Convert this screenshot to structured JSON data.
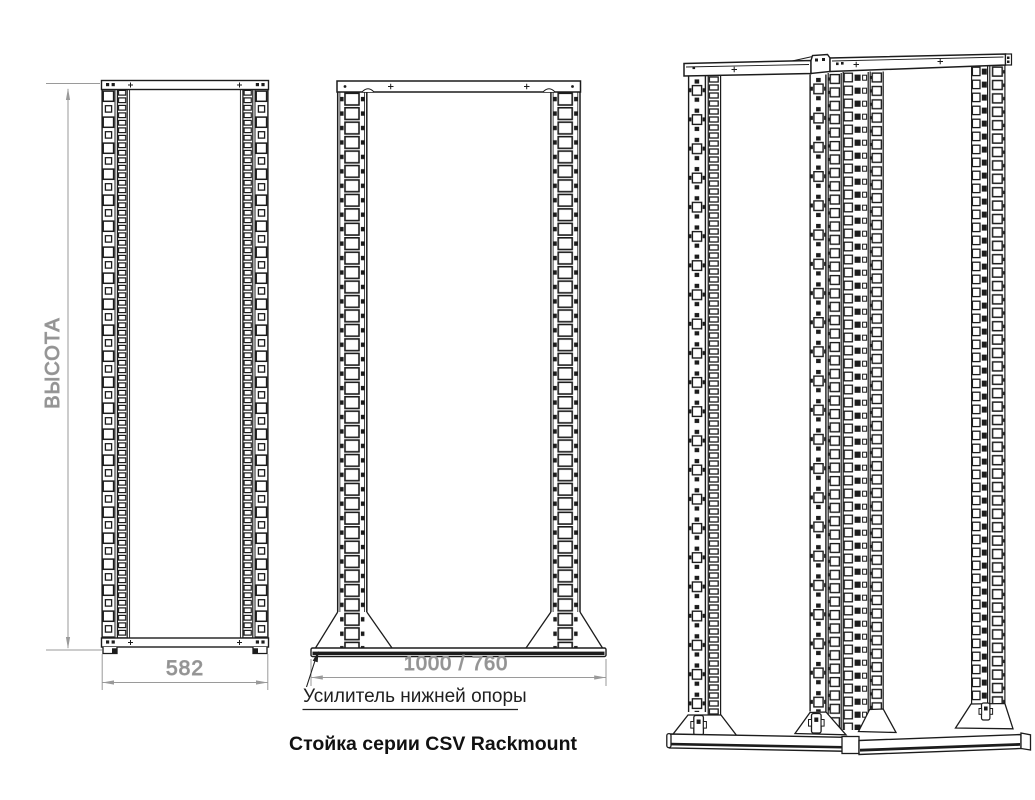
{
  "labels": {
    "height_dim": "ВЫСОТА",
    "depth_dim": "582",
    "width_dim": "1000 / 760",
    "base_callout": "Усилитель нижней опоры",
    "caption": "Стойка серии CSV Rackmount"
  },
  "colors": {
    "line": "#1c1c1c",
    "dimension": "#9a9a9a",
    "dimension_text": "#8f8f8f",
    "callout_text": "#1f1f1f",
    "background": "#ffffff"
  }
}
